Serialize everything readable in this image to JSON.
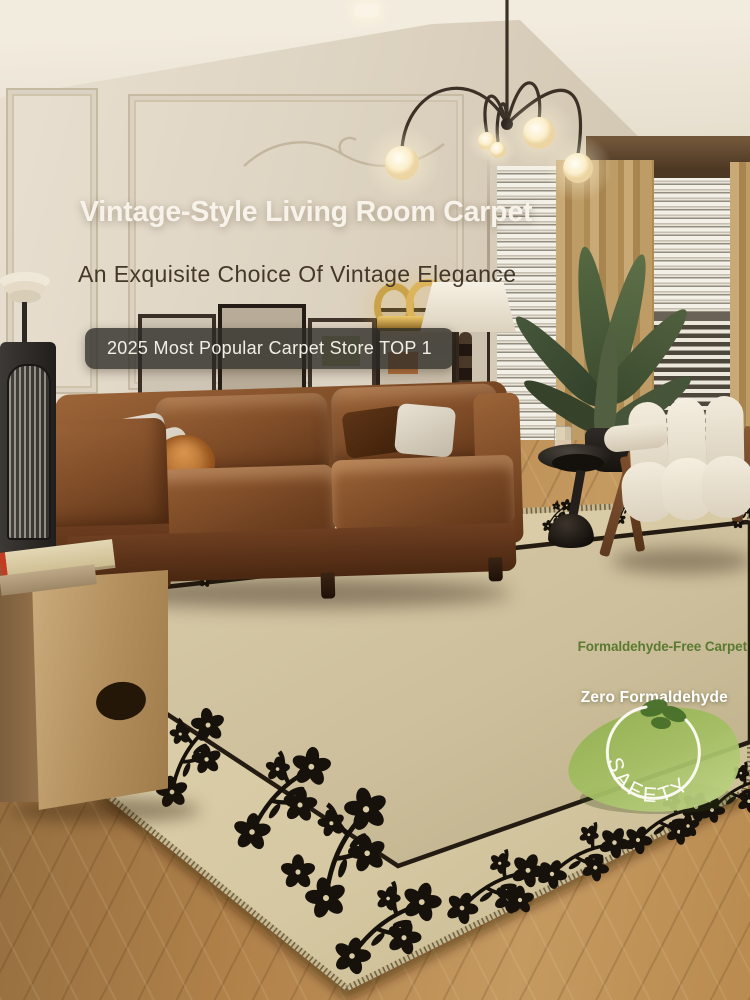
{
  "overlay": {
    "title": "Vintage-Style Living Room Carpet",
    "subtitle": "An Exquisite Choice Of Vintage Elegance",
    "rank_badge": "2025 Most Popular Carpet Store TOP 1",
    "features": {
      "free_carpet": "Formaldehyde-Free Carpet",
      "zero_formaldehyde": "Zero Formaldehyde",
      "safety": "SAFETY"
    }
  },
  "icons": {
    "safety_leaf_icon": "leaf-badge-with-arc",
    "floral_motif_icon": "plum-blossom-sprig"
  },
  "colors": {
    "title_text": "#f8f3ea",
    "subtitle_text": "#44382a",
    "rank_badge_bg": "rgba(44,42,38,0.78)",
    "rank_badge_text": "#f2eee4",
    "feature_green": "#5a7a31",
    "feature_white": "#ffffff",
    "safety_text": "#fdfcf7",
    "leaf_green_dark": "#6f9a3f",
    "leaf_green_light": "#b9d07f",
    "carpet_field": "#cfc29e",
    "carpet_band": "#d9cca7",
    "carpet_border_line": "#241c12",
    "floral_black": "#16110b",
    "sofa_leather": "#7c4a26",
    "wood_floor": "#b08149",
    "wall": "#ddd3c1",
    "curtain": "#bb9a63"
  }
}
